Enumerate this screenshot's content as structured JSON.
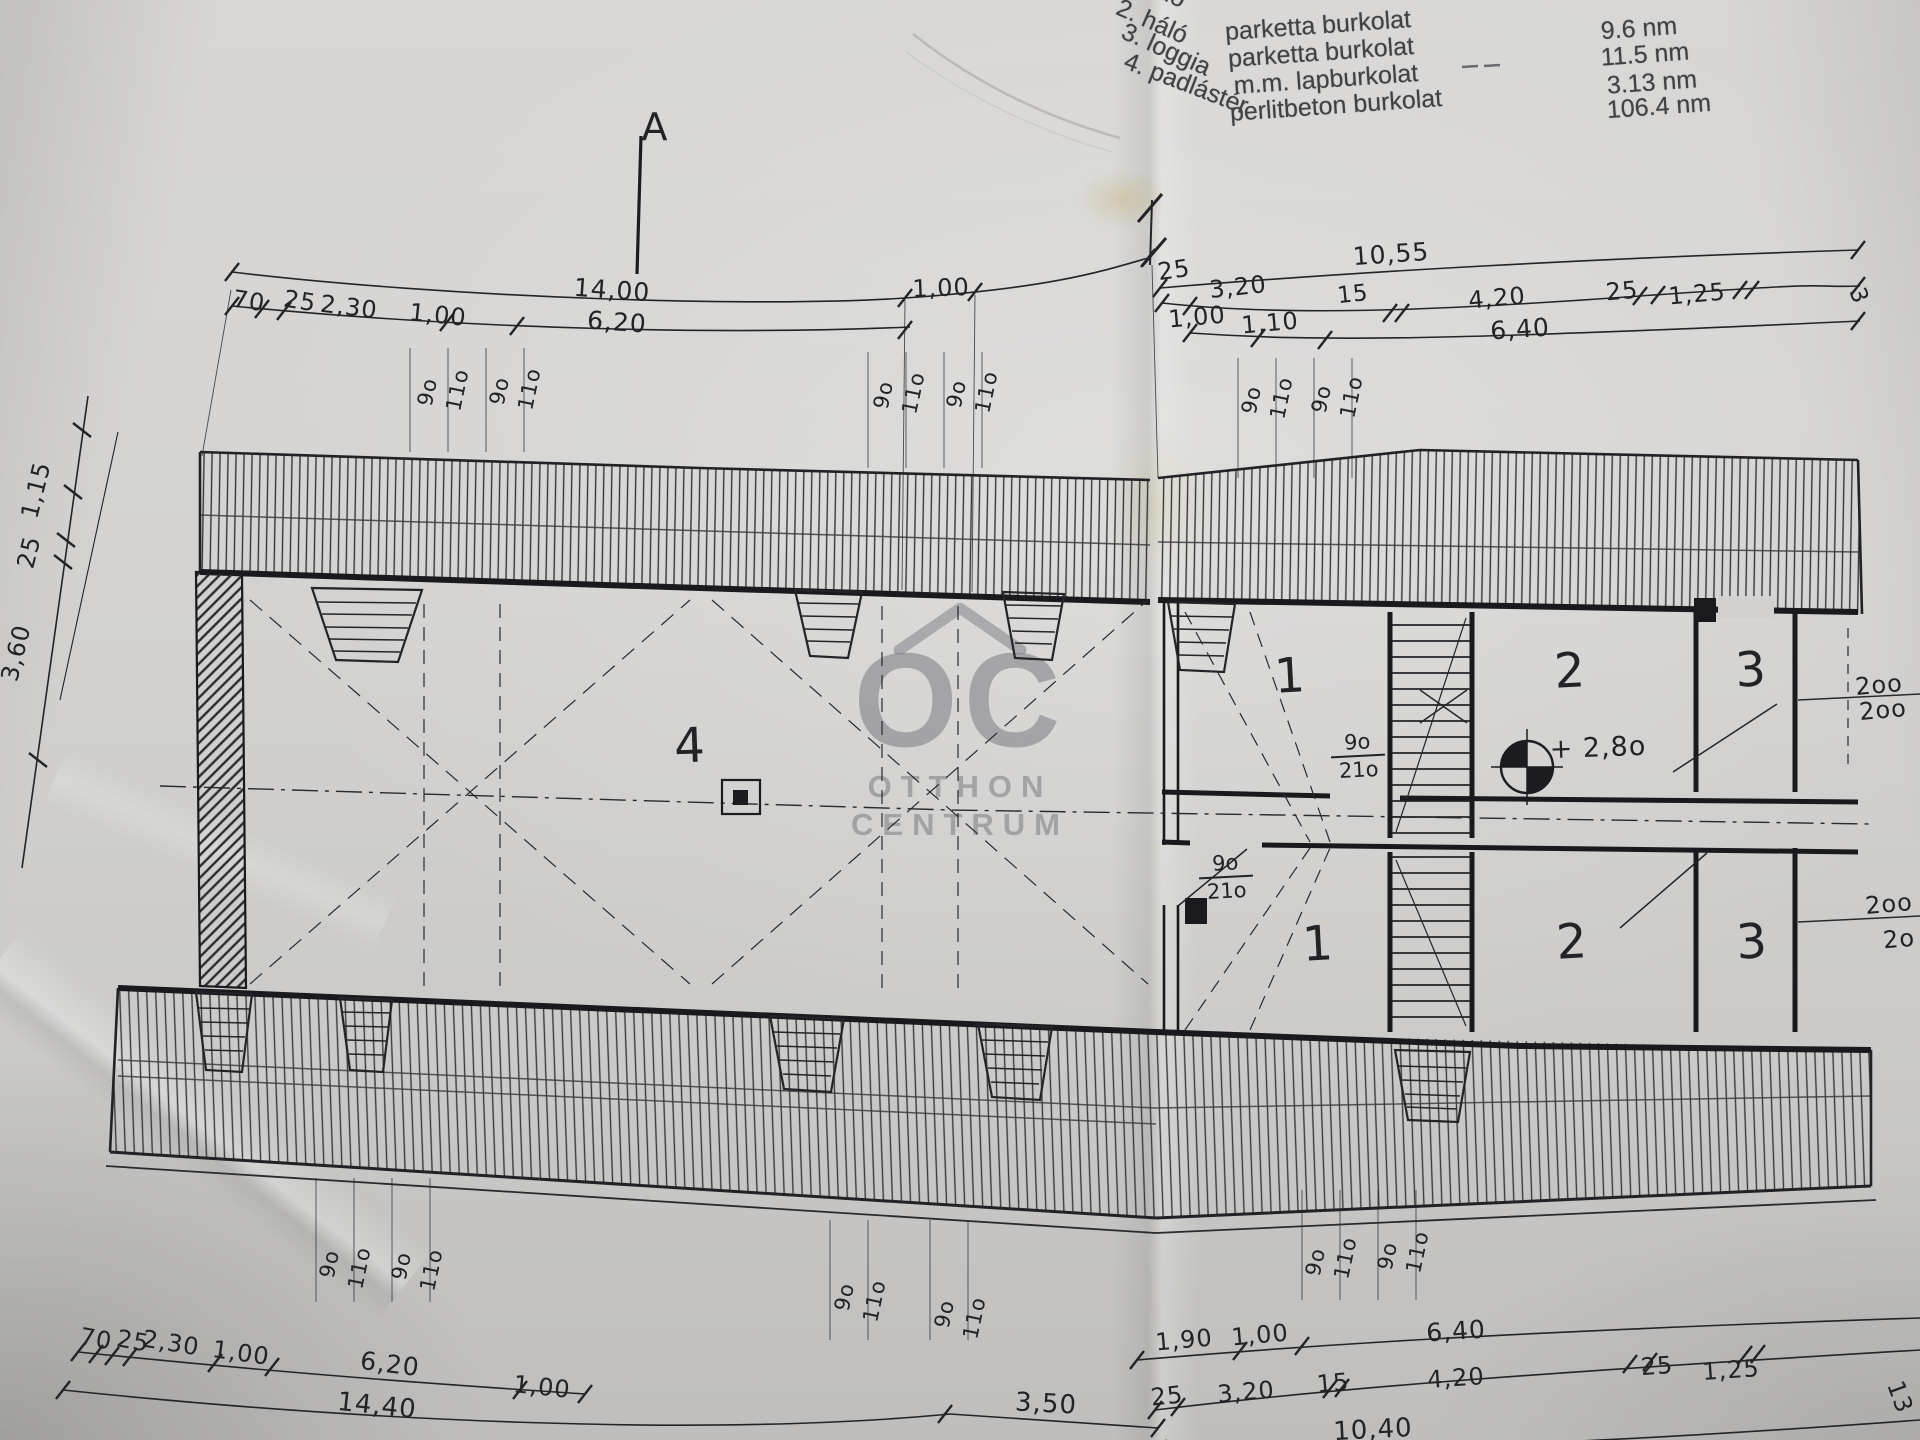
{
  "legend": {
    "items": [
      {
        "t": "1. háló",
        "x": 1150,
        "y": -14,
        "r": 24
      },
      {
        "t": "2. háló",
        "x": 1152,
        "y": 22,
        "r": 24
      },
      {
        "t": "3. loggia",
        "x": 1166,
        "y": 50,
        "r": 24
      },
      {
        "t": "4. padlástér",
        "x": 1186,
        "y": 84,
        "r": 21
      }
    ],
    "floors": [
      {
        "t": "parketta burkolat",
        "x": 1318,
        "y": 26,
        "r": -4
      },
      {
        "t": "parketta burkolat",
        "x": 1321,
        "y": 53,
        "r": -4
      },
      {
        "t": "m.m. lapburkolat",
        "x": 1326,
        "y": 80,
        "r": -4
      },
      {
        "t": "perlitbeton burkolat",
        "x": 1336,
        "y": 106,
        "r": -4
      }
    ],
    "areas": [
      {
        "t": "9.6 nm",
        "x": 1639,
        "y": 29,
        "r": -4
      },
      {
        "t": "11.5 nm",
        "x": 1645,
        "y": 55,
        "r": -4
      },
      {
        "t": "3.13 nm",
        "x": 1652,
        "y": 83,
        "r": -4
      },
      {
        "t": "106.4 nm",
        "x": 1659,
        "y": 107,
        "r": -4
      }
    ]
  },
  "section_marker": {
    "label": "A"
  },
  "watermark": {
    "monogram": "OC",
    "line1": "OTTHON",
    "line2": "CENTRUM"
  },
  "level_marker": {
    "text": "+ 2,8o"
  },
  "room_labels": [
    {
      "t": "4",
      "x": 690,
      "y": 746,
      "r": -2
    },
    {
      "t": "1",
      "x": 1290,
      "y": 676,
      "r": -3
    },
    {
      "t": "2",
      "x": 1570,
      "y": 671,
      "r": -3
    },
    {
      "t": "3",
      "x": 1751,
      "y": 670,
      "r": -3
    },
    {
      "t": "1",
      "x": 1318,
      "y": 944,
      "r": -3
    },
    {
      "t": "2",
      "x": 1572,
      "y": 942,
      "r": -3
    },
    {
      "t": "3",
      "x": 1752,
      "y": 942,
      "r": -3
    }
  ],
  "door_labels": [
    {
      "top": "9o",
      "bottom": "21o",
      "x": 1358,
      "y": 757,
      "r": -3
    },
    {
      "top": "9o",
      "bottom": "21o",
      "x": 1226,
      "y": 878,
      "r": -3
    }
  ],
  "dim_labels": [
    {
      "t": "14,00",
      "x": 612,
      "y": 290,
      "r": 4,
      "s": 25
    },
    {
      "t": "70",
      "x": 249,
      "y": 301,
      "r": 9
    },
    {
      "t": "25",
      "x": 300,
      "y": 301,
      "r": 9
    },
    {
      "t": "2,30",
      "x": 349,
      "y": 307,
      "r": 7
    },
    {
      "t": "1,00",
      "x": 438,
      "y": 315,
      "r": 6
    },
    {
      "t": "6,20",
      "x": 617,
      "y": 322,
      "r": 4,
      "s": 25
    },
    {
      "t": "1,00",
      "x": 941,
      "y": 288,
      "r": -2
    },
    {
      "t": "10,55",
      "x": 1391,
      "y": 254,
      "r": -4,
      "s": 25
    },
    {
      "t": "25",
      "x": 1174,
      "y": 270,
      "r": -8
    },
    {
      "t": "3,20",
      "x": 1238,
      "y": 287,
      "r": -6
    },
    {
      "t": "15",
      "x": 1353,
      "y": 295,
      "r": -6,
      "s": 23
    },
    {
      "t": "4,20",
      "x": 1497,
      "y": 298,
      "r": -5
    },
    {
      "t": "25",
      "x": 1622,
      "y": 291,
      "r": -5
    },
    {
      "t": "1,25",
      "x": 1697,
      "y": 294,
      "r": -5
    },
    {
      "t": "3",
      "x": 1858,
      "y": 296,
      "r": 70,
      "s": 23
    },
    {
      "t": "1,00",
      "x": 1197,
      "y": 317,
      "r": -5
    },
    {
      "t": "1,10",
      "x": 1270,
      "y": 323,
      "r": -5
    },
    {
      "t": "6,40",
      "x": 1520,
      "y": 329,
      "r": -4,
      "s": 25
    },
    {
      "t": "1,15",
      "x": 36,
      "y": 490,
      "r": -76
    },
    {
      "t": "25",
      "x": 29,
      "y": 552,
      "r": -76
    },
    {
      "t": "3,60",
      "x": 16,
      "y": 653,
      "r": -76
    },
    {
      "t": "2oo",
      "x": 1879,
      "y": 685,
      "r": -5
    },
    {
      "t": "2oo",
      "x": 1883,
      "y": 710,
      "r": -5
    },
    {
      "t": "2oo",
      "x": 1889,
      "y": 904,
      "r": -5
    },
    {
      "t": "2o",
      "x": 1899,
      "y": 939,
      "r": -5
    },
    {
      "t": "70",
      "x": 96,
      "y": 1339,
      "r": 10
    },
    {
      "t": "25",
      "x": 133,
      "y": 1341,
      "r": 10
    },
    {
      "t": "2,30",
      "x": 171,
      "y": 1343,
      "r": 9
    },
    {
      "t": "1,00",
      "x": 241,
      "y": 1353,
      "r": 8
    },
    {
      "t": "6,20",
      "x": 390,
      "y": 1364,
      "r": 7,
      "s": 25
    },
    {
      "t": "1,00",
      "x": 542,
      "y": 1387,
      "r": 6
    },
    {
      "t": "14,40",
      "x": 377,
      "y": 1406,
      "r": 6,
      "s": 26
    },
    {
      "t": "3,50",
      "x": 1046,
      "y": 1404,
      "r": 3,
      "s": 26
    },
    {
      "t": "1,90",
      "x": 1184,
      "y": 1340,
      "r": -5
    },
    {
      "t": "1,00",
      "x": 1260,
      "y": 1335,
      "r": -5
    },
    {
      "t": "6,40",
      "x": 1456,
      "y": 1331,
      "r": -4,
      "s": 25
    },
    {
      "t": "25",
      "x": 1167,
      "y": 1396,
      "r": -6
    },
    {
      "t": "3,20",
      "x": 1246,
      "y": 1392,
      "r": -5
    },
    {
      "t": "15",
      "x": 1333,
      "y": 1383,
      "r": -5
    },
    {
      "t": "4,20",
      "x": 1456,
      "y": 1378,
      "r": -4
    },
    {
      "t": "25",
      "x": 1657,
      "y": 1366,
      "r": -4
    },
    {
      "t": "1,25",
      "x": 1731,
      "y": 1370,
      "r": -4
    },
    {
      "t": "10,40",
      "x": 1373,
      "y": 1430,
      "r": -3,
      "s": 26
    },
    {
      "t": "13",
      "x": 1900,
      "y": 1397,
      "r": 70
    }
  ],
  "window_labels": [
    {
      "t": "9o",
      "x": 428,
      "y": 392,
      "r": -78
    },
    {
      "t": "11o",
      "x": 458,
      "y": 390,
      "r": -78
    },
    {
      "t": "9o",
      "x": 500,
      "y": 391,
      "r": -78
    },
    {
      "t": "11o",
      "x": 530,
      "y": 389,
      "r": -78
    },
    {
      "t": "9o",
      "x": 884,
      "y": 395,
      "r": -78
    },
    {
      "t": "11o",
      "x": 914,
      "y": 393,
      "r": -78
    },
    {
      "t": "9o",
      "x": 957,
      "y": 394,
      "r": -78
    },
    {
      "t": "11o",
      "x": 987,
      "y": 392,
      "r": -78
    },
    {
      "t": "9o",
      "x": 1252,
      "y": 400,
      "r": -78
    },
    {
      "t": "11o",
      "x": 1282,
      "y": 398,
      "r": -78
    },
    {
      "t": "9o",
      "x": 1322,
      "y": 399,
      "r": -78
    },
    {
      "t": "11o",
      "x": 1352,
      "y": 397,
      "r": -78
    },
    {
      "t": "9o",
      "x": 330,
      "y": 1264,
      "r": -78
    },
    {
      "t": "11o",
      "x": 360,
      "y": 1268,
      "r": -78
    },
    {
      "t": "9o",
      "x": 402,
      "y": 1266,
      "r": -78
    },
    {
      "t": "11o",
      "x": 432,
      "y": 1270,
      "r": -78
    },
    {
      "t": "9o",
      "x": 845,
      "y": 1297,
      "r": -78
    },
    {
      "t": "11o",
      "x": 875,
      "y": 1301,
      "r": -78
    },
    {
      "t": "9o",
      "x": 945,
      "y": 1314,
      "r": -78
    },
    {
      "t": "11o",
      "x": 975,
      "y": 1318,
      "r": -78
    },
    {
      "t": "9o",
      "x": 1316,
      "y": 1262,
      "r": -78
    },
    {
      "t": "11o",
      "x": 1346,
      "y": 1258,
      "r": -78
    },
    {
      "t": "9o",
      "x": 1388,
      "y": 1256,
      "r": -78
    },
    {
      "t": "11o",
      "x": 1418,
      "y": 1252,
      "r": -78
    }
  ]
}
